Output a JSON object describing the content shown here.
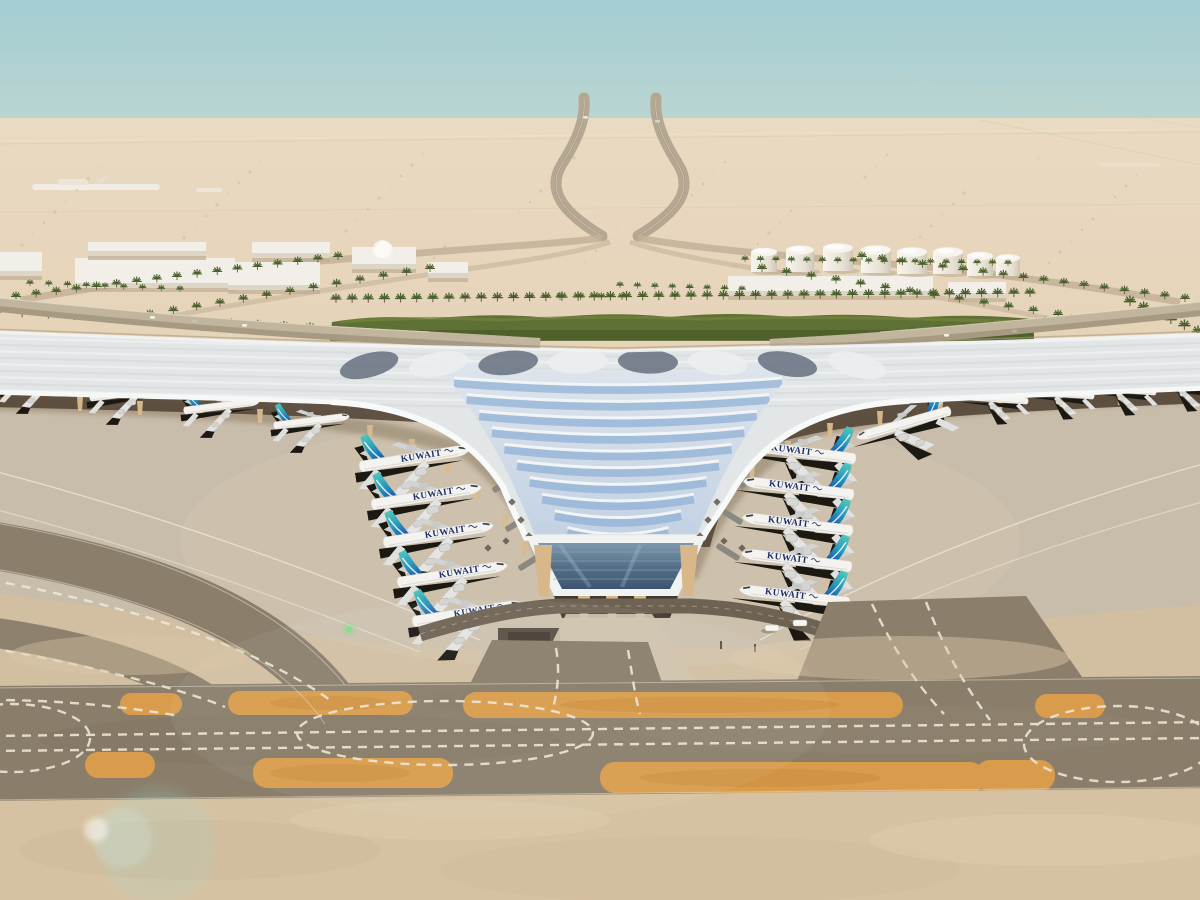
{
  "image": {
    "width": 1200,
    "height": 900
  },
  "airline": {
    "wordmark": "KUWAIT",
    "wordmark_color": "#1d2d69",
    "tail_teal": "#4fc7b2",
    "tail_blue": "#1b5fae"
  },
  "palette": {
    "sky_top": "#a4cdd2",
    "sky_haze": "#e7d9c3",
    "sand_far": "#e6d4ba",
    "sand_fore": "#d6c2a2",
    "apron": "#c8bdaa",
    "taxiway": "#8a7e6b",
    "taxiway_paint_orange": "#d89c4c",
    "marking_white": "#ece6d8",
    "roof_silver": "#e3e6e7",
    "roof_glass_blue": "#8fb0d6",
    "roof_slate": "#66707f",
    "hedge_green": "#5f7034",
    "palm_green": "#48602c",
    "column_tan": "#d9ba8e",
    "road_grey": "#a79a83"
  },
  "counts": {
    "aircraft_total": 16,
    "labeled_aircraft": 10,
    "fuel_tanks": 8
  },
  "aircraft_rows": [
    {
      "name": "left-pier",
      "mx": 1,
      "rot": -9,
      "s": 1.08,
      "label": true,
      "items": [
        [
          415,
          458
        ],
        [
          427,
          496
        ],
        [
          439,
          534
        ],
        [
          453,
          574
        ],
        [
          468,
          613
        ]
      ]
    },
    {
      "name": "right-pier",
      "mx": -1,
      "rot": 7,
      "s": 1.08,
      "label": true,
      "items": [
        [
          800,
          452
        ],
        [
          798,
          488
        ],
        [
          797,
          524
        ],
        [
          796,
          560
        ],
        [
          794,
          596
        ]
      ]
    },
    {
      "name": "right-pier-top",
      "mx": -1,
      "rot": -16,
      "s": 0.95,
      "label": false,
      "items": [
        [
          903,
          424
        ]
      ]
    },
    {
      "name": "left-wing-stands",
      "mx": 1,
      "rot": -7,
      "s": 0.74,
      "label": false,
      "items": [
        [
          38,
          382
        ],
        [
          128,
          393
        ],
        [
          222,
          406
        ],
        [
          312,
          421
        ]
      ]
    },
    {
      "name": "right-wing-stands",
      "mx": -1,
      "rot": 4,
      "s": 0.62,
      "label": false,
      "items": [
        [
          996,
          399
        ],
        [
          1062,
          394
        ],
        [
          1124,
          390
        ],
        [
          1186,
          386
        ]
      ]
    }
  ],
  "jet_bridges": {
    "left": [
      [
        492,
        444,
        -32
      ],
      [
        504,
        484,
        -32
      ],
      [
        517,
        523,
        -32
      ],
      [
        530,
        562,
        -32
      ]
    ],
    "right": [
      [
        737,
        444,
        32
      ],
      [
        734,
        480,
        32
      ],
      [
        731,
        516,
        32
      ],
      [
        728,
        552,
        32
      ]
    ]
  },
  "palm_rows": [
    {
      "f": [
        336,
        303
      ],
      "t": [
        1030,
        297
      ],
      "n": 44,
      "s": 1.0
    },
    {
      "f": [
        16,
        300
      ],
      "t": [
        338,
        260
      ],
      "n": 17,
      "s": 0.9
    },
    {
      "f": [
        150,
        318
      ],
      "t": [
        430,
        272
      ],
      "n": 13,
      "s": 0.9
    },
    {
      "f": [
        862,
        260
      ],
      "t": [
        1185,
        302
      ],
      "n": 17,
      "s": 0.9
    },
    {
      "f": [
        762,
        272
      ],
      "t": [
        1058,
        318
      ],
      "n": 13,
      "s": 0.9
    },
    {
      "f": [
        -4,
        316
      ],
      "t": [
        310,
        332
      ],
      "n": 13,
      "s": 1.0
    },
    {
      "f": [
        886,
        338
      ],
      "t": [
        1204,
        314
      ],
      "n": 13,
      "s": 1.0
    },
    {
      "f": [
        745,
        262
      ],
      "t": [
        1008,
        266
      ],
      "n": 18,
      "s": 0.7
    },
    {
      "f": [
        620,
        288
      ],
      "t": [
        742,
        292
      ],
      "n": 8,
      "s": 0.7
    },
    {
      "f": [
        30,
        286
      ],
      "t": [
        180,
        292
      ],
      "n": 9,
      "s": 0.7
    },
    {
      "f": [
        1130,
        306
      ],
      "t": [
        1198,
        336
      ],
      "n": 6,
      "s": 1.1
    },
    {
      "f": [
        560,
        300
      ],
      "t": [
        622,
        300
      ],
      "n": 4,
      "s": 0.8
    }
  ],
  "fuel_tanks": [
    [
      764,
      252,
      13,
      20
    ],
    [
      800,
      250,
      14,
      22
    ],
    [
      838,
      248,
      15,
      23
    ],
    [
      876,
      250,
      15,
      23
    ],
    [
      912,
      252,
      15,
      22
    ],
    [
      948,
      252,
      15,
      22
    ],
    [
      980,
      256,
      13,
      20
    ],
    [
      1008,
      258,
      12,
      18
    ]
  ],
  "buildings": [
    [
      0,
      252,
      42,
      24,
      0
    ],
    [
      75,
      258,
      160,
      30,
      0
    ],
    [
      88,
      242,
      118,
      14,
      0
    ],
    [
      228,
      262,
      92,
      28,
      0
    ],
    [
      252,
      242,
      78,
      16,
      0
    ],
    [
      352,
      247,
      64,
      22,
      1
    ],
    [
      428,
      262,
      40,
      16,
      0
    ],
    [
      728,
      276,
      205,
      20,
      0
    ],
    [
      948,
      282,
      58,
      16,
      0
    ]
  ],
  "facade_columns": {
    "left": [
      [
        80,
        404
      ],
      [
        140,
        408
      ],
      [
        200,
        412
      ],
      [
        260,
        416
      ],
      [
        318,
        422
      ],
      [
        370,
        432
      ],
      [
        412,
        446
      ],
      [
        448,
        466
      ],
      [
        478,
        492
      ],
      [
        505,
        522
      ],
      [
        524,
        548
      ]
    ],
    "right": [
      [
        1120,
        398
      ],
      [
        1060,
        400
      ],
      [
        1000,
        404
      ],
      [
        940,
        410
      ],
      [
        880,
        418
      ],
      [
        830,
        430
      ],
      [
        788,
        448
      ],
      [
        752,
        472
      ],
      [
        722,
        500
      ],
      [
        702,
        526
      ],
      [
        690,
        548
      ]
    ]
  },
  "cars": [
    [
      150,
      316,
      "#f4f2ec"
    ],
    [
      192,
      320,
      "#c8c2b6"
    ],
    [
      242,
      324,
      "#f4f2ec"
    ],
    [
      944,
      334,
      "#f4f2ec"
    ],
    [
      1012,
      330,
      "#b9b2a4"
    ],
    [
      583,
      116,
      "#e8e5dd"
    ],
    [
      655,
      120,
      "#d8d3c8"
    ]
  ],
  "apron_vehicles": [
    [
      800,
      623,
      "van"
    ],
    [
      772,
      628,
      "cart"
    ]
  ],
  "roof_pattern": {
    "chevrons": {
      "cx": 618,
      "y0": 383,
      "rows": 10,
      "step": 16.6,
      "w0": 164,
      "wstep": 12.6
    },
    "fan_xs": [
      368,
      438,
      508,
      578,
      648,
      718,
      788,
      858
    ],
    "fan_y": 361
  }
}
